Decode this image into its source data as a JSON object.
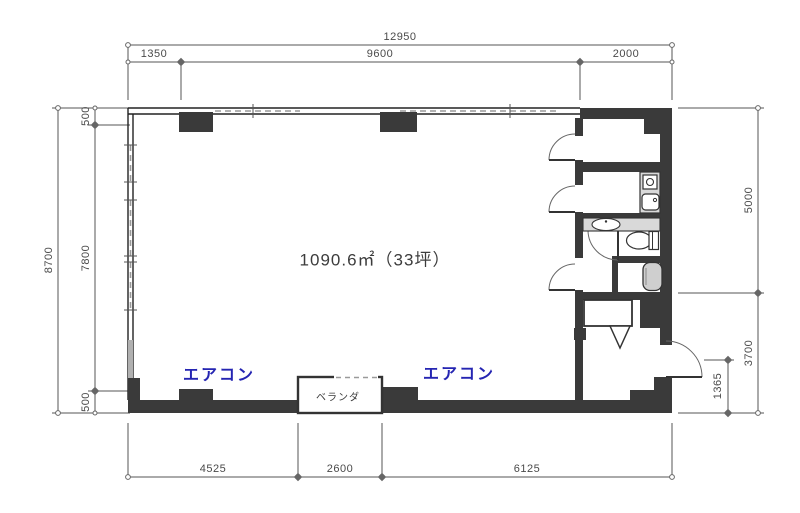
{
  "plan": {
    "area_label": "1090.6㎡（33坪）",
    "aircon_left": "エアコン",
    "aircon_right": "エアコン",
    "veranda": "ベランダ"
  },
  "dimensions": {
    "top": {
      "total": "12950",
      "segments": [
        "1350",
        "9600",
        "2000"
      ]
    },
    "left": {
      "total": "8700",
      "segments": [
        "500",
        "7800",
        "500"
      ]
    },
    "right": {
      "segments": [
        "5000",
        "3700"
      ],
      "entry_offset": "1365"
    },
    "bottom": {
      "segments": [
        "4525",
        "2600",
        "6125"
      ]
    }
  },
  "colors": {
    "wall": "#3a3a3a",
    "counter": "#d9d9d9",
    "dim_line": "#555555",
    "dim_text": "#4a4a4a",
    "aircon_text": "#2525b2"
  }
}
